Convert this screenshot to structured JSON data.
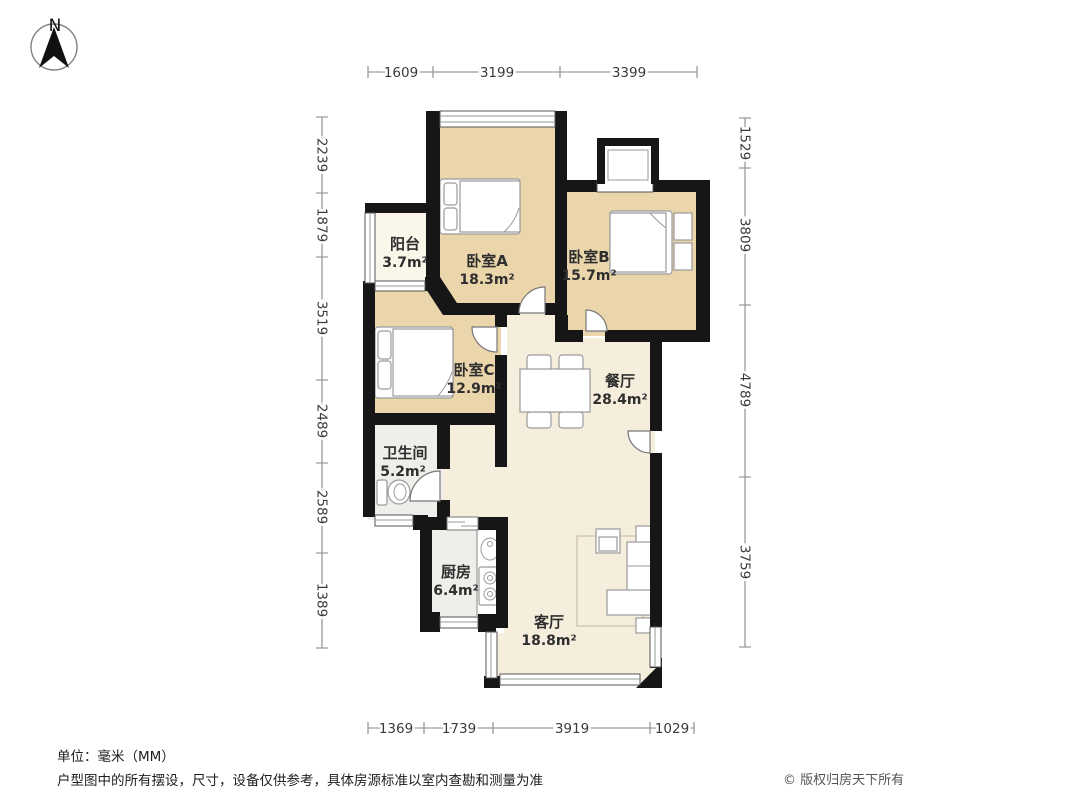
{
  "compass": {
    "label": "N"
  },
  "dimensions": {
    "top": [
      "1609",
      "3199",
      "3399"
    ],
    "bottom": [
      "1369",
      "1739",
      "3919",
      "1029"
    ],
    "left": [
      "2239",
      "1879",
      "3519",
      "2489",
      "2589",
      "1389"
    ],
    "right": [
      "1529",
      "3809",
      "4789",
      "3759"
    ]
  },
  "rooms": [
    {
      "name": "阳台",
      "area": "3.7m²"
    },
    {
      "name": "卧室A",
      "area": "18.3m²"
    },
    {
      "name": "卧室B",
      "area": "15.7m²"
    },
    {
      "name": "卧室C",
      "area": "12.9m²"
    },
    {
      "name": "餐厅",
      "area": "28.4m²"
    },
    {
      "name": "卫生间",
      "area": "5.2m²"
    },
    {
      "name": "厨房",
      "area": "6.4m²"
    },
    {
      "name": "客厅",
      "area": "18.8m²"
    }
  ],
  "footer": {
    "unit_note": "单位：毫米（MM）",
    "disclaimer": "户型图中的所有摆设，尺寸，设备仅供参考，具体房源标准以室内查勘和测量为准",
    "copyright": "© 版权归房天下所有"
  },
  "colors": {
    "wall": "#161616",
    "bedroom_floor": "#ebd6ac",
    "living_floor": "#f6eedd",
    "service_floor": "#efeeea",
    "balcony_floor": "#faf6e9",
    "dim_line": "#9a9a9a",
    "dim_text": "#3b3b3b"
  }
}
